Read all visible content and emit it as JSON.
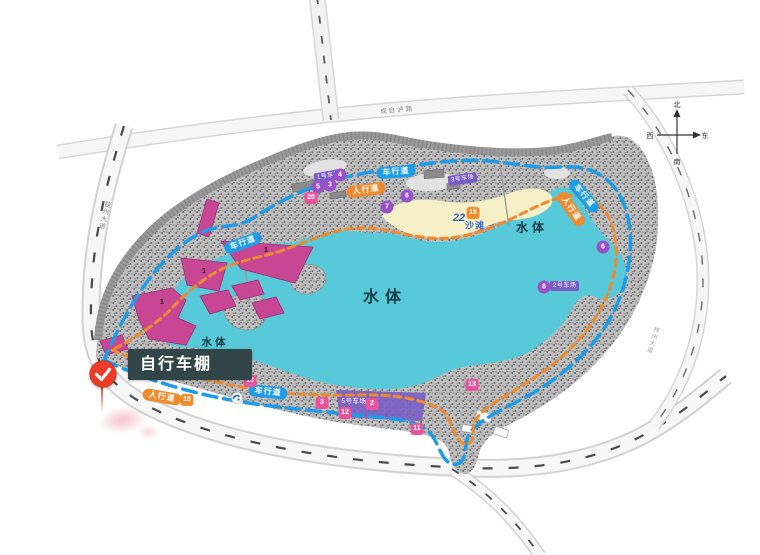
{
  "callout": {
    "label": "自行车棚"
  },
  "pin": {
    "icon": "check",
    "glyph": "✓"
  },
  "compass": {
    "north": "北",
    "south": "南",
    "east": "东",
    "west": "西"
  },
  "roads": {
    "top_label": "成自泸路",
    "left_label": "益州大道",
    "right_label": "梓州大道"
  },
  "water": {
    "labels": [
      "水体",
      "水体",
      "水体"
    ]
  },
  "beach": {
    "label": "沙滩",
    "number": "22"
  },
  "path_labels": {
    "vehicle": "车行道",
    "pedestrian": "人行道"
  },
  "badges": {
    "purple_circles": [
      "5",
      "3",
      "4",
      "7",
      "6",
      "6",
      "8"
    ],
    "pink_squares": [
      "20",
      "13",
      "3",
      "2",
      "12",
      "11",
      "13"
    ],
    "orange_squares": [
      "15",
      "15"
    ]
  },
  "parking": {
    "small_west": "1号车场",
    "small_north": "3号车场",
    "east": "2号车场",
    "main": "5号车场"
  },
  "buildings": {
    "numbers": [
      "1",
      "1",
      "1"
    ]
  },
  "icons": {
    "pin": "check-pin-icon",
    "compass": "compass-rose-icon",
    "emblem": "circular-emblem-icon"
  },
  "colors": {
    "lake": "#58c9d8",
    "sand": "#f6f0c8",
    "building": "#c84795",
    "parking": "#7a5cc6",
    "vehicle_path": "#1d9ce8",
    "pedestrian_path": "#ef8a2e",
    "pin": "#ee3b25",
    "callout_bg": "#324549",
    "badge_pink": "#e8549b",
    "badge_purple": "#9a50c8",
    "badge_orange": "#f08c2a"
  }
}
